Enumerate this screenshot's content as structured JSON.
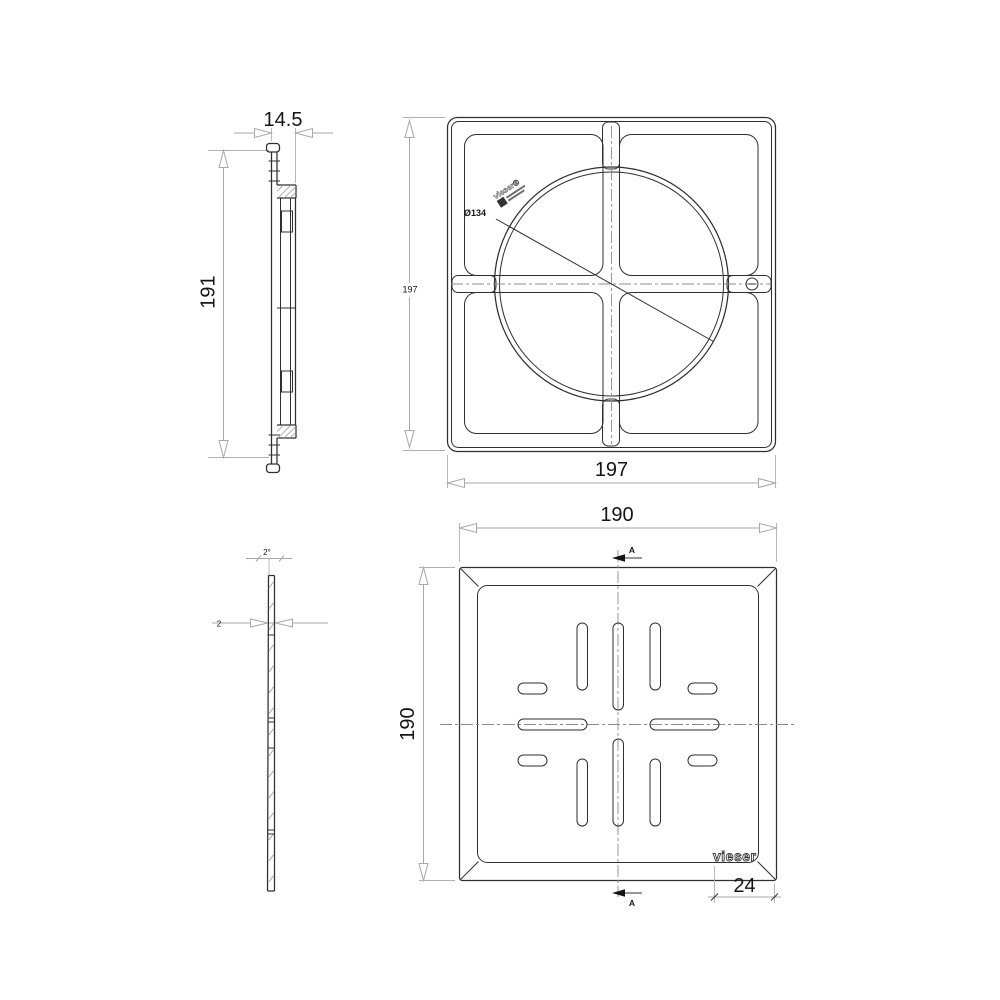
{
  "views": {
    "frame_side": {
      "width_dim": "14.5",
      "height_dim": "191"
    },
    "frame_front": {
      "width_dim": "197",
      "height_dim": "197",
      "diameter_label": "Ø134",
      "logo_text": "vieser®"
    },
    "grate_side": {
      "angle_dim": "2°",
      "thickness_dim": "2"
    },
    "grate_front": {
      "top_dim": "190",
      "left_dim": "190",
      "logo_text": "vieser",
      "logo_width_dim": "24",
      "section_top": "A",
      "section_bottom": "A"
    }
  },
  "colors": {
    "background": "#ffffff",
    "object_line": "#2f2f2f",
    "dimension_line": "#a8a8a8",
    "centerline": "#8c8c8c",
    "text": "#151515"
  }
}
